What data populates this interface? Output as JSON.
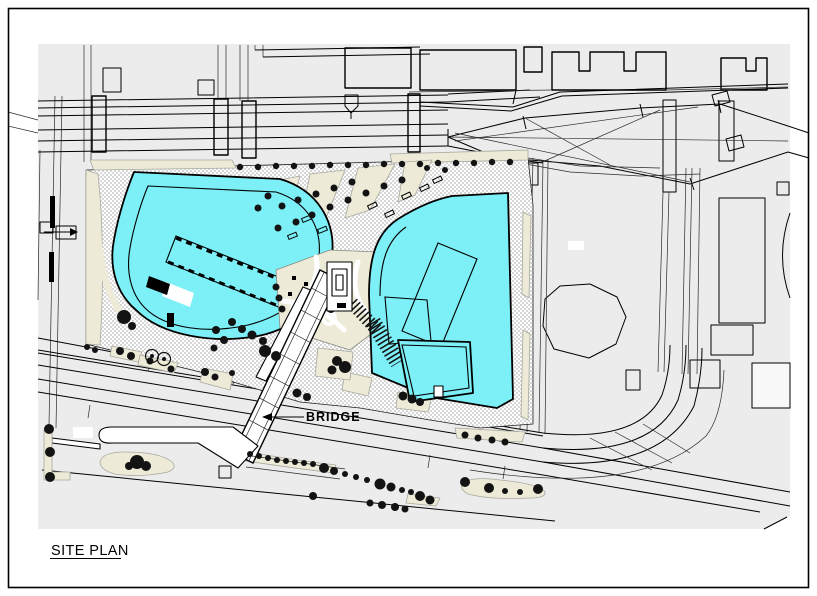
{
  "sheet": {
    "type": "architectural-site-plan-drawing",
    "width_px": 817,
    "height_px": 596
  },
  "labels": {
    "bridge": "BRIDGE",
    "title": "SITE PLAN"
  },
  "colors": {
    "paper": "#FFFFFF",
    "frame": "#000000",
    "ink": "#000000",
    "context_gray": "#ECECEC",
    "hatch_gray": "#D7D7D7",
    "building_cyan": "#7DEFF7",
    "planting_beige": "#EDEBD8",
    "tree": "#131313"
  }
}
